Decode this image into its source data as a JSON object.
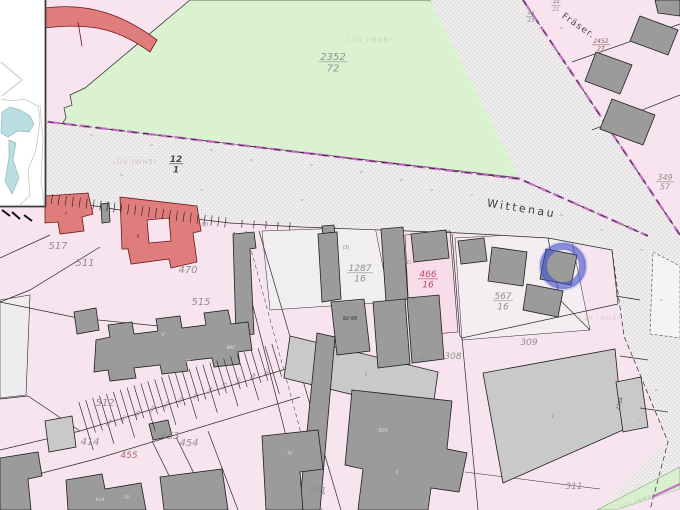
{
  "map": {
    "type": "cadastral-map-view",
    "streets": [
      {
        "t": "Wittenau",
        "x": 521,
        "y": 212,
        "s": 11,
        "r": 9,
        "ls": 2.5,
        "c": "#3c3c3c"
      },
      {
        "t": "Fräser.",
        "x": 577,
        "y": 28,
        "s": 9,
        "r": 34,
        "ls": 1.2,
        "c": "#4a4a4a"
      }
    ],
    "parcel_labels": [
      {
        "t": "517",
        "x": 58,
        "y": 249,
        "s": 10
      },
      {
        "t": "511",
        "x": 85,
        "y": 266,
        "s": 10
      },
      {
        "t": "470",
        "x": 188,
        "y": 273,
        "s": 10
      },
      {
        "t": "515",
        "x": 201,
        "y": 305,
        "s": 10
      },
      {
        "t": "512",
        "x": 105,
        "y": 406,
        "s": 10
      },
      {
        "t": "414",
        "x": 90,
        "y": 445,
        "s": 10
      },
      {
        "t": "453",
        "x": 170,
        "y": 439,
        "s": 10
      },
      {
        "t": "454",
        "x": 189,
        "y": 446,
        "s": 10
      },
      {
        "t": "455",
        "x": 129,
        "y": 458,
        "s": 9,
        "c": "#b06a6a"
      },
      {
        "t": "451",
        "x": 317,
        "y": 494,
        "s": 10
      },
      {
        "t": "308",
        "x": 453,
        "y": 359,
        "s": 9
      },
      {
        "t": "309",
        "x": 529,
        "y": 345,
        "s": 9
      },
      {
        "t": "311",
        "x": 574,
        "y": 489,
        "s": 9
      }
    ],
    "fractions": [
      {
        "num": "2352",
        "den": "72",
        "x": 333,
        "y": 60,
        "s": 10
      },
      {
        "num": "12",
        "den": "1",
        "x": 176,
        "y": 162,
        "s": 9,
        "c": "#4a4a4a",
        "b": true
      },
      {
        "num": "1287",
        "den": "16",
        "x": 360,
        "y": 271,
        "s": 9
      },
      {
        "num": "466",
        "den": "16",
        "x": 428,
        "y": 277,
        "s": 9,
        "c": "#c04a6a"
      },
      {
        "num": "567",
        "den": "16",
        "x": 503,
        "y": 299,
        "s": 9
      },
      {
        "num": "349",
        "den": "57",
        "x": 665,
        "y": 180,
        "s": 8
      },
      {
        "num": "2452",
        "den": "27",
        "x": 601,
        "y": 43,
        "s": 6,
        "c": "#8a5a5a"
      },
      {
        "num": "44",
        "den": "21",
        "x": 556,
        "y": 4,
        "s": 5.5
      },
      {
        "num": "44",
        "den": "23",
        "x": 531,
        "y": 15,
        "s": 5.5
      }
    ],
    "lot_numbers": [
      "519",
      "521",
      "523",
      "525",
      "527",
      "529",
      "531",
      "533",
      "535",
      "537",
      "539",
      "541"
    ],
    "building_labels": [
      {
        "t": "92-96",
        "x": 350,
        "y": 320,
        "s": 5,
        "c": "#2f2f2f"
      },
      {
        "t": "90A",
        "x": 383,
        "y": 432,
        "s": 5,
        "c": "#d6d6d6"
      },
      {
        "t": "118A",
        "x": 621,
        "y": 404,
        "s": 5,
        "c": "#555555",
        "r": -72
      },
      {
        "t": "66B",
        "x": 103,
        "y": 336,
        "s": 4.5,
        "c": "#e4e4e4"
      },
      {
        "t": "V",
        "x": 163,
        "y": 336,
        "s": 5,
        "c": "#e4e4e4"
      },
      {
        "t": "VI",
        "x": 188,
        "y": 363,
        "s": 5,
        "c": "#e4e4e4"
      },
      {
        "t": "66C",
        "x": 231,
        "y": 349,
        "s": 4.5,
        "c": "#e4e4e4"
      },
      {
        "t": "I",
        "x": 66,
        "y": 215,
        "s": 5,
        "c": "#7a2a2a"
      },
      {
        "t": "II",
        "x": 138,
        "y": 238,
        "s": 5,
        "c": "#7a2a2a"
      },
      {
        "t": "I",
        "x": 366,
        "y": 376,
        "s": 6,
        "c": "#8a8a8a"
      },
      {
        "t": "I",
        "x": 553,
        "y": 418,
        "s": 6,
        "c": "#8a8a8a"
      },
      {
        "t": "II",
        "x": 397,
        "y": 474,
        "s": 5,
        "c": "#d0d0d0"
      },
      {
        "t": "IV",
        "x": 290,
        "y": 455,
        "s": 5,
        "c": "#dcdcdc"
      },
      {
        "t": "IV",
        "x": 127,
        "y": 499,
        "s": 5,
        "c": "#dcdcdc"
      },
      {
        "t": "61A",
        "x": 100,
        "y": 501,
        "s": 4.5,
        "c": "#dcdcdc"
      }
    ],
    "annotations": [
      {
        "t": "(2)",
        "x": 205,
        "y": 226
      },
      {
        "t": "(3)",
        "x": 346,
        "y": 249
      },
      {
        "t": "(1)",
        "x": 408,
        "y": 264
      },
      {
        "t": "(7)",
        "x": 412,
        "y": 302
      },
      {
        "t": "(4)",
        "x": 422,
        "y": 359
      }
    ],
    "watermarks": [
      {
        "t": "LÜV (WNB)",
        "x": 135,
        "y": 164,
        "s": 6.5,
        "c": "#c9c4c6"
      },
      {
        "t": "LÜV (WNB)",
        "x": 370,
        "y": 42,
        "s": 6.5,
        "c": "#bdd8b6"
      },
      {
        "t": "LÜV (WNB)",
        "x": 600,
        "y": 320,
        "s": 6,
        "c": "#d5cfd3"
      },
      {
        "t": "LÜV (WNB)",
        "x": 638,
        "y": 503,
        "s": 5,
        "c": "#a9c9a1",
        "r": -19
      }
    ],
    "highlight_circle": {
      "x": 563,
      "y": 266,
      "r": 19.5,
      "color": "#4050c8"
    },
    "colors": {
      "background_pink": "#f8e4ee",
      "parcel_white": "#f1eef1",
      "green_area": "#dbf2d1",
      "road_fill": "#efeced",
      "road_dot": "#cbc7c9",
      "building_dark": "#9b9b9b",
      "building_light": "#c9c9c9",
      "building_red": "#df7d7d",
      "boundary_magenta": "#c45ec4",
      "label_gray": "#8f8f8f",
      "selected_parcel": "#f8dce9",
      "water_blue": "#badee1",
      "highlight_blue": "#4050c8"
    }
  }
}
